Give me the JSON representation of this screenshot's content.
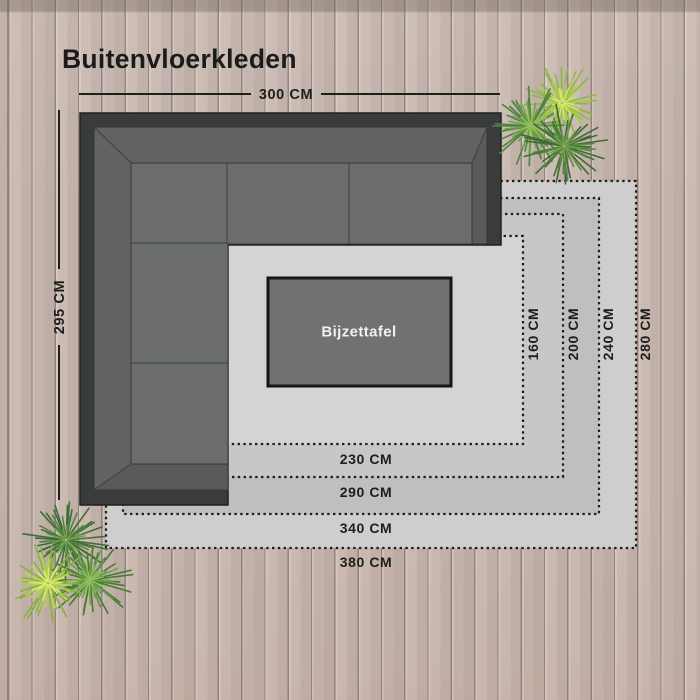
{
  "title": "Buitenvloerkleden",
  "sofa": {
    "width_label": "300 CM",
    "depth_label": "295 CM",
    "frame_color": "#393c3b",
    "cushion_color": "#6a6d6c",
    "backrest_color": "#616463",
    "armrest_color": "#585b5a",
    "seam_color": "#454847"
  },
  "side_table": {
    "label": "Bijzettafel",
    "fill": "#6f7271",
    "border": "#161616",
    "text_color": "#f1f1f1"
  },
  "rugs": [
    {
      "size": "380 x 280",
      "width_label": "380 CM",
      "height_label": "280 CM",
      "fill": "#cecece"
    },
    {
      "size": "340 x 240",
      "width_label": "340 CM",
      "height_label": "240 CM",
      "fill": "#bfbfbf"
    },
    {
      "size": "290 x 200",
      "width_label": "290 CM",
      "height_label": "200 CM",
      "fill": "#c7c7c7"
    },
    {
      "size": "230 x 160",
      "width_label": "230 CM",
      "height_label": "160 CM",
      "fill": "#d4d4d4"
    }
  ],
  "rug_border_color": "#1d1d1d",
  "rug_label_color": "#1e1e1e",
  "dimension_color": "#1e1e1e",
  "plants": [
    {
      "id": "plant-icon-top-right",
      "tufts": [
        {
          "cx": 562,
          "cy": 103,
          "r": 34,
          "colors": [
            "#8fb944",
            "#a9cc49",
            "#d7e76a"
          ]
        },
        {
          "cx": 531,
          "cy": 126,
          "r": 36,
          "colors": [
            "#4e8340",
            "#6fa04b",
            "#96c257"
          ]
        },
        {
          "cx": 564,
          "cy": 146,
          "r": 38,
          "colors": [
            "#3e6c35",
            "#55883f",
            "#74a24c"
          ]
        }
      ]
    },
    {
      "id": "plant-icon-bottom-left",
      "tufts": [
        {
          "cx": 66,
          "cy": 540,
          "r": 38,
          "colors": [
            "#3e6c35",
            "#4f8040",
            "#74a24c"
          ]
        },
        {
          "cx": 90,
          "cy": 580,
          "r": 38,
          "colors": [
            "#477a36",
            "#66a14a",
            "#93c159"
          ]
        },
        {
          "cx": 48,
          "cy": 583,
          "r": 36,
          "colors": [
            "#86b23f",
            "#b7d44e",
            "#ddeb74"
          ]
        }
      ]
    }
  ]
}
